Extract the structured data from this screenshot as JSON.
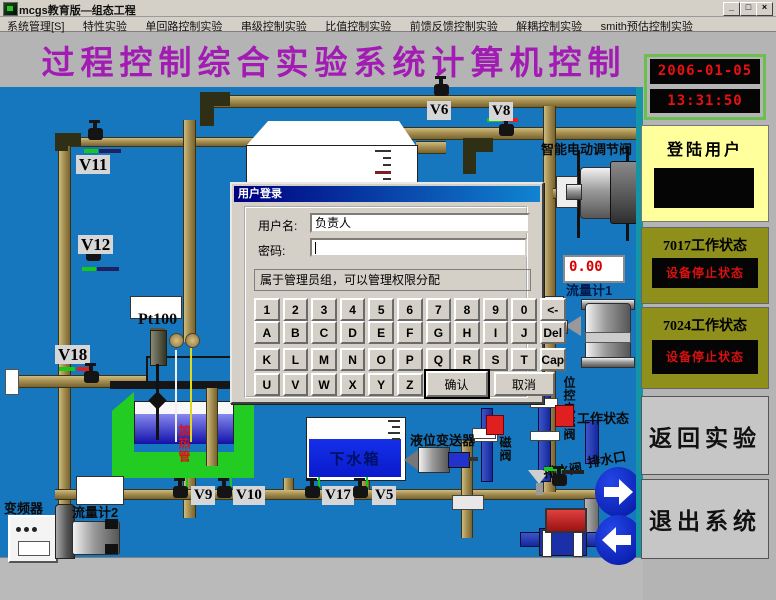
{
  "window": {
    "title": "mcgs教育版—组态工程",
    "minimize": "_",
    "restore": "□",
    "close": "×"
  },
  "menu": {
    "items": [
      "系统管理[S]",
      "特性实验",
      "单回路控制实验",
      "串级控制实验",
      "比值控制实验",
      "前馈反馈控制实验",
      "解耦控制实验",
      "smith预估控制实验"
    ]
  },
  "banner": {
    "title": "过程控制综合实验系统计算机控制"
  },
  "sidebar": {
    "date": "2006-01-05",
    "time": "13:31:50",
    "login_user_label": "登陆用户",
    "status7017": {
      "title": "7017工作状态",
      "status": "设备停止状态"
    },
    "status7024": {
      "title": "7024工作状态",
      "status": "设备停止状态"
    },
    "back_button": "返回实验",
    "exit_button": "退出系统"
  },
  "dialog": {
    "title": "用户登录",
    "username_label": "用户名:",
    "username_value": "负责人",
    "password_label": "密码:",
    "password_value": "",
    "info": "属于管理员组，可以管理权限分配",
    "keys_row1": [
      "1",
      "2",
      "3",
      "4",
      "5",
      "6",
      "7",
      "8",
      "9",
      "0",
      "<-"
    ],
    "keys_row2": [
      "A",
      "B",
      "C",
      "D",
      "E",
      "F",
      "G",
      "H",
      "I",
      "J",
      "Del"
    ],
    "keys_row3": [
      "K",
      "L",
      "M",
      "N",
      "O",
      "P",
      "Q",
      "R",
      "S",
      "T",
      "Cap"
    ],
    "keys_row4": [
      "U",
      "V",
      "W",
      "X",
      "Y",
      "Z"
    ],
    "ok_button": "确认",
    "cancel_button": "取消"
  },
  "diagram": {
    "valves": {
      "v5": "V5",
      "v6": "V6",
      "v8": "V8",
      "v9": "V9",
      "v10": "V10",
      "v11": "V11",
      "v12": "V12",
      "v17": "V17",
      "v18": "V18"
    },
    "smart_valve": "智能电动调节阀",
    "flow1_value": "0.00",
    "flow1": "流量计1",
    "flow2": "流量计2",
    "pt100": "Pt100",
    "heater_pipe": "加热管",
    "inverter": "变频器",
    "lower_tank": "下水箱",
    "level_transmitter": "液位变送器",
    "solenoid_partial": "磁阀",
    "position_solenoid": "位控电磁阀",
    "work_status": "工作状态",
    "drain_valve": "排水阀",
    "drain_outlet": "排水口"
  },
  "colors": {
    "canvas_blue": "#1777be",
    "banner_purple": "#a21cb4",
    "led_red": "#e81010",
    "status_red": "#d81010"
  }
}
